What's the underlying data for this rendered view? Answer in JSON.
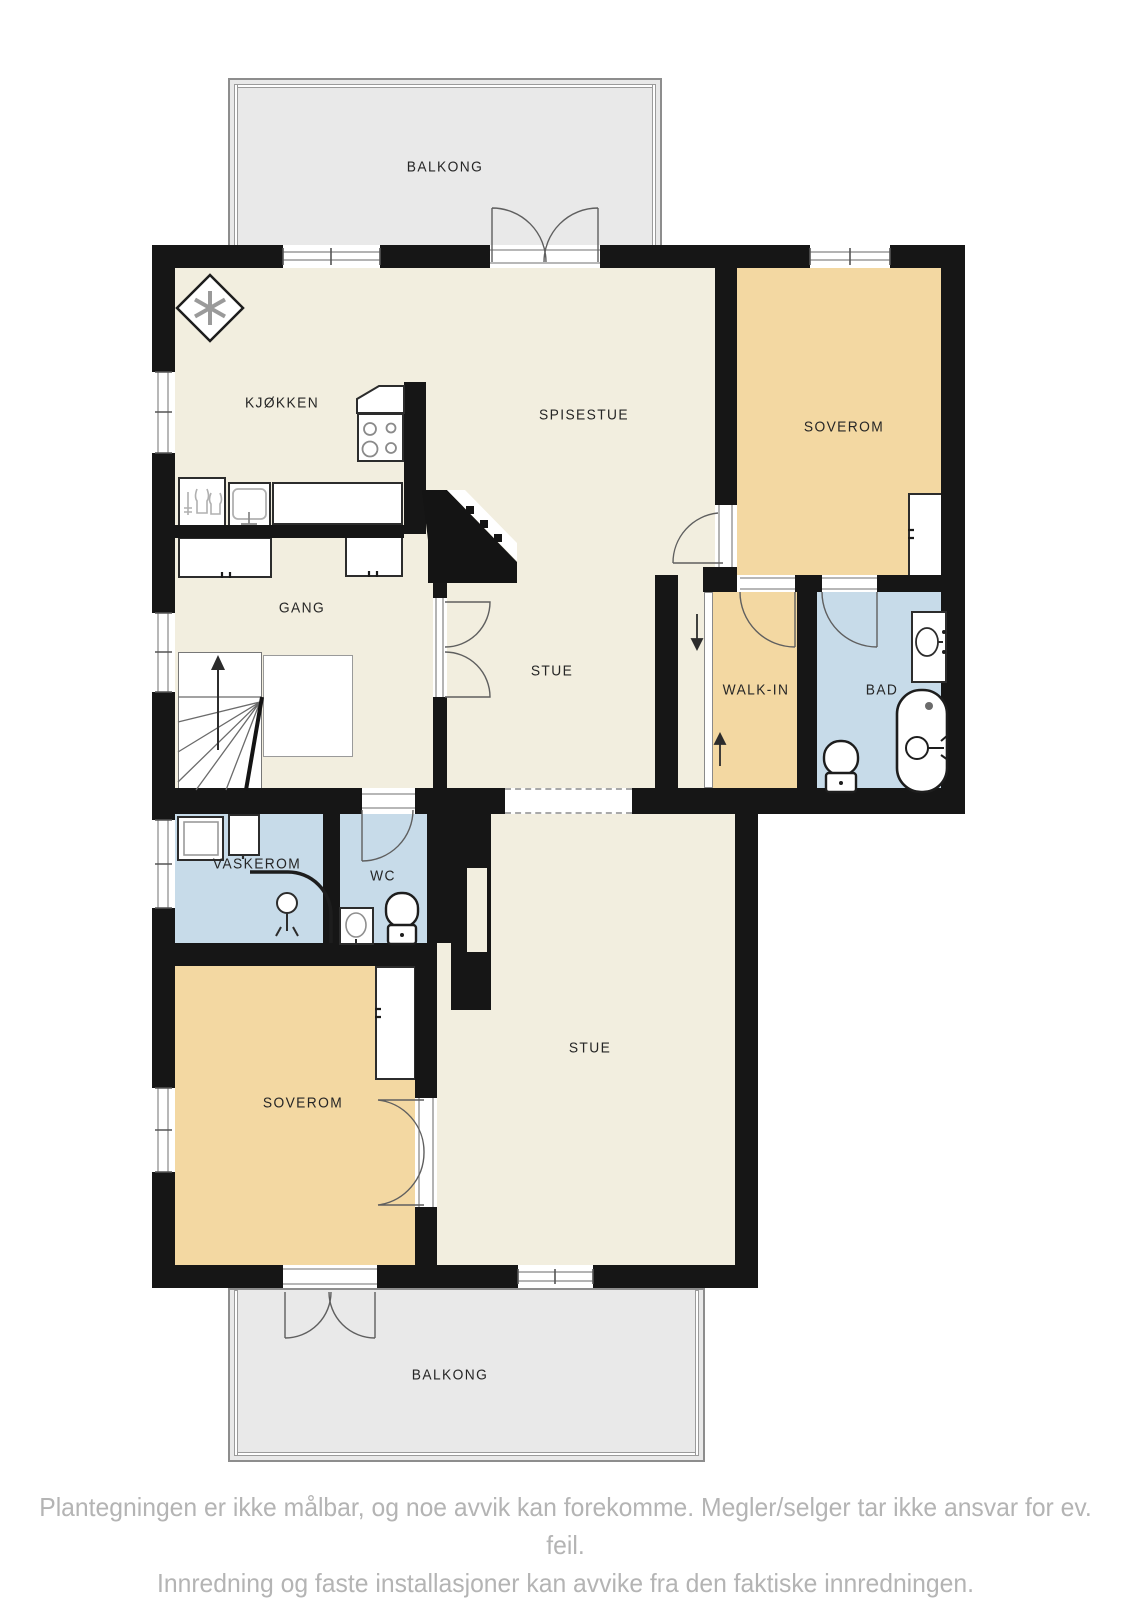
{
  "floorplan": {
    "type": "residential-floor-plan",
    "rooms": [
      {
        "id": "balkong-top",
        "label": "BALKONG"
      },
      {
        "id": "kjokken",
        "label": "KJØKKEN"
      },
      {
        "id": "spisestue",
        "label": "SPISESTUE"
      },
      {
        "id": "soverom-top",
        "label": "SOVEROM"
      },
      {
        "id": "gang",
        "label": "GANG"
      },
      {
        "id": "stue-mid",
        "label": "STUE"
      },
      {
        "id": "walk-in",
        "label": "WALK-IN"
      },
      {
        "id": "bad",
        "label": "BAD"
      },
      {
        "id": "vaskerom",
        "label": "VASKEROM"
      },
      {
        "id": "wc",
        "label": "WC"
      },
      {
        "id": "soverom-bottom",
        "label": "SOVEROM"
      },
      {
        "id": "stue-bottom",
        "label": "STUE"
      },
      {
        "id": "balkong-bottom",
        "label": "BALKONG"
      }
    ],
    "colors": {
      "floor": "#f2eedf",
      "bedroom": "#f3d8a2",
      "wet_room": "#c7dbe9",
      "balcony": "#e9e9e9",
      "wall": "#161616",
      "label_text": "#262626",
      "footer_text": "#b4b4b4"
    },
    "icons": [
      "chimney-icon",
      "stove-icon",
      "kitchen-sink-icon",
      "dishwasher-icon",
      "stairs-up-icon",
      "wardrobe-icon",
      "washing-machine-icon",
      "shower-icon",
      "wc-sink-icon",
      "toilet-icon",
      "bathtub-icon",
      "vanity-sink-icon",
      "sliding-door-icon",
      "arrow-down-icon",
      "arrow-up-icon"
    ]
  },
  "disclaimer": {
    "line1": "Plantegningen er ikke målbar, og noe avvik kan forekomme. Megler/selger tar ikke ansvar for ev. feil.",
    "line2": "Innredning og faste installasjoner kan avvike fra den faktiske innredningen."
  }
}
